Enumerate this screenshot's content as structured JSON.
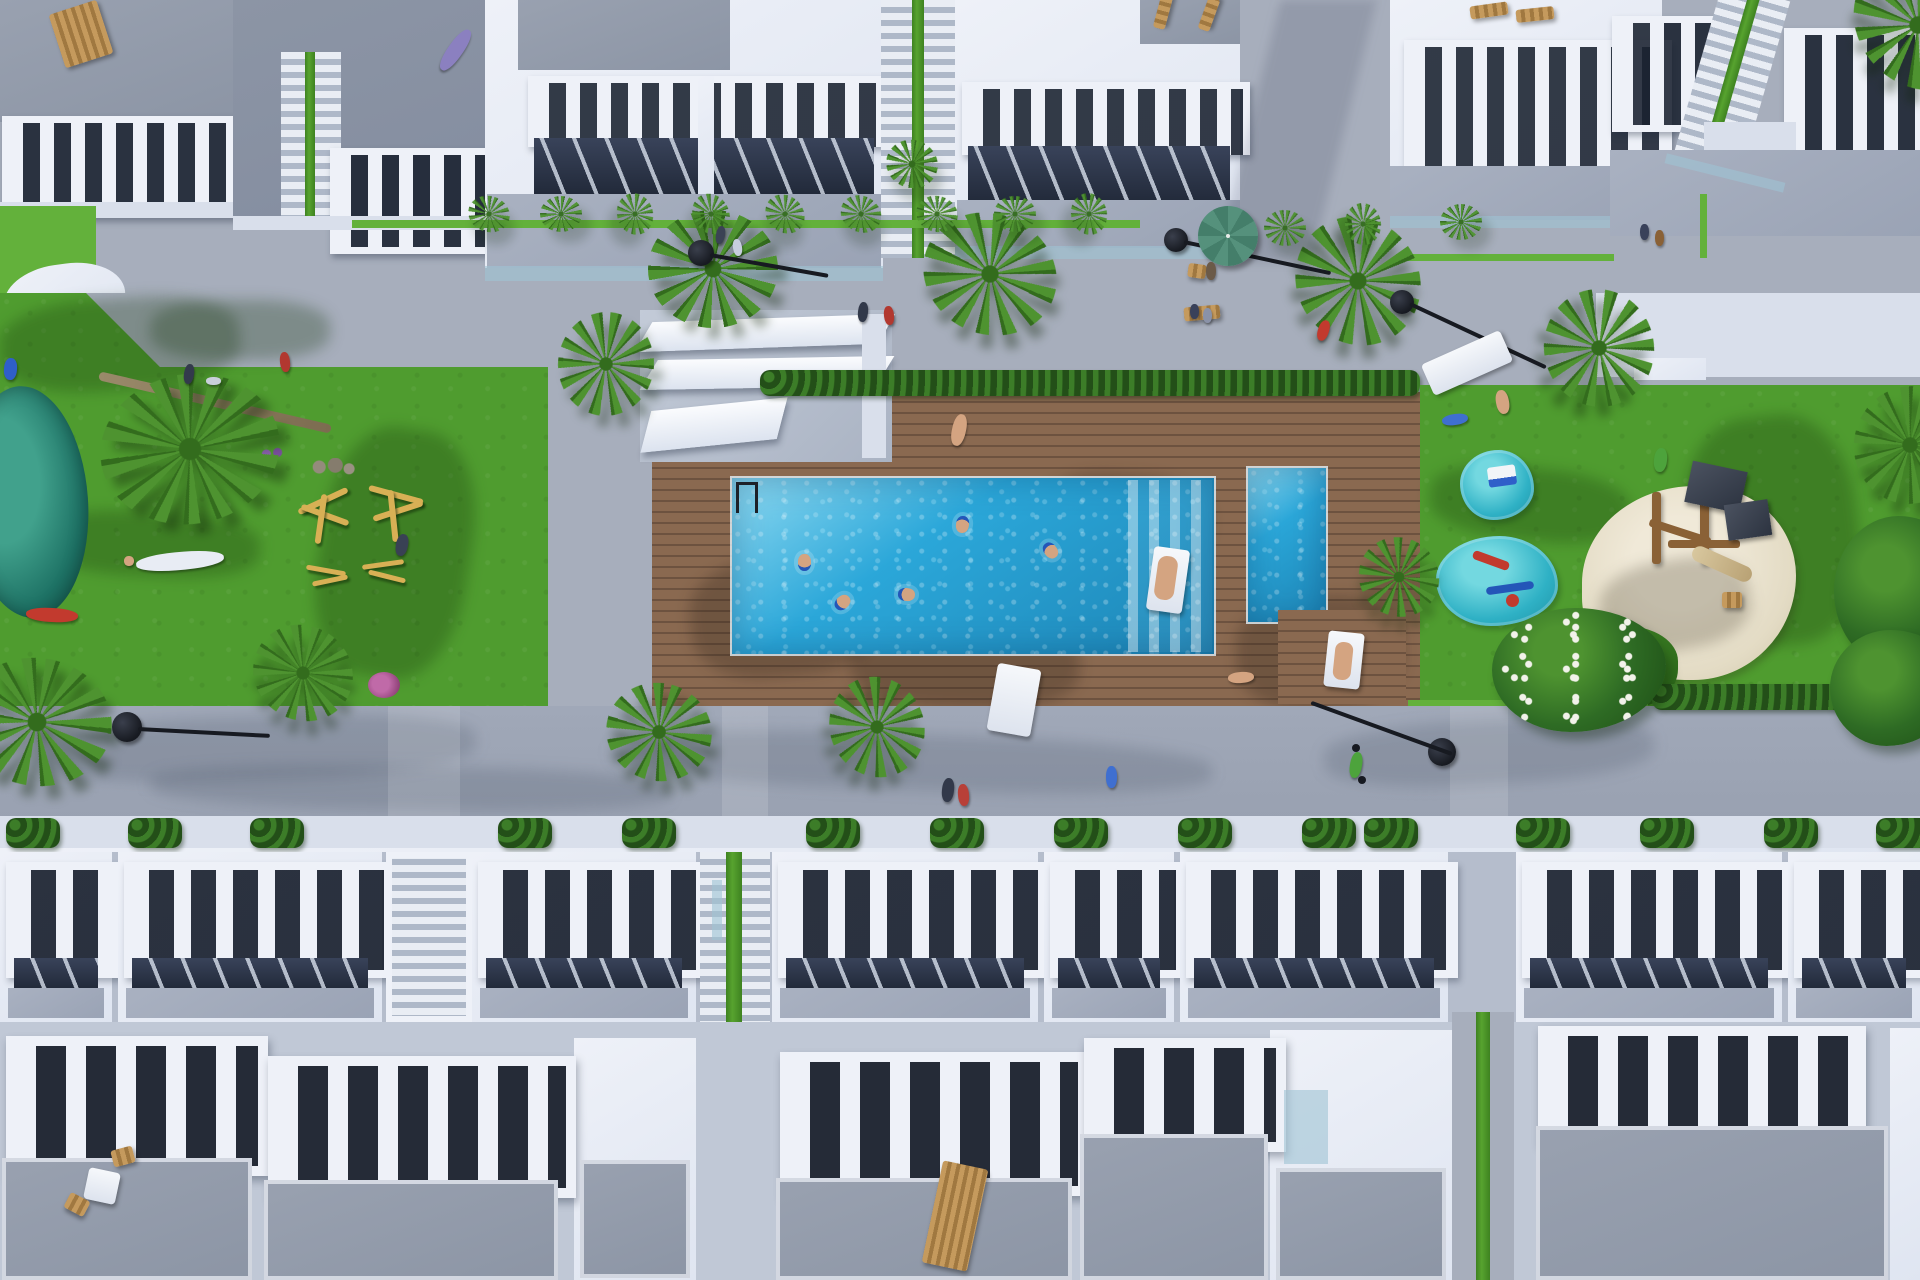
{
  "scene": {
    "kind": "3d-aerial-architectural-render",
    "setting": "residential complex courtyard, top-down view",
    "features": [
      "rows of white townhouses with roof terraces and white balustrades",
      "communal rectangular swimming pool with underwater steps and ladder",
      "separate children's pool",
      "wooden sun deck with plank texture",
      "white pergola shade structure",
      "large lawns with outdoor wooden exercise equipment",
      "small pond",
      "two turquoise children's splash pads with play toys",
      "sand playground with wooden play tower and slide",
      "green mound with red slide",
      "palm trees and dense green hedges",
      "black street lamps with round heads",
      "green parasol on a terrace",
      "sun loungers, wooden deck chairs, bench and outdoor table set",
      "people swimming, sunbathing, walking, cycling and playing"
    ]
  },
  "colors": {
    "concrete": "#a7aebc",
    "street": "#9aa2b2",
    "roof": "#99a1b0",
    "roof2": "#8c95a5",
    "white": "#eef1f8",
    "white2": "#d9dfeb",
    "floor": "#a9b1c1",
    "gap": "#27303f",
    "glass": "#9fc3d4",
    "lawn": "#4f9c2f",
    "lawn2": "#63b13b",
    "lawnshadow": "#2e6317",
    "deck": "#8a6950",
    "deckline": "#6d523f",
    "pool": "#2ba7d9",
    "pooldeep": "#1d85b6",
    "poollight": "#8ed9f1",
    "hedge": "#2d6420",
    "palm": "#4e9330",
    "palmdark": "#336c1d",
    "tree": "#2e6b24",
    "treedark": "#1d4d15",
    "pond": "#1d7164",
    "pond2": "#41a18c",
    "sand": "#e3dbc4",
    "splash": "#2fb1c5",
    "wood": "#c49a5c",
    "wood2": "#8a6136",
    "lamp": "#171a21",
    "umbrella": "#55917c",
    "red": "#c23a2e",
    "blue": "#2f5fc9",
    "skin": "#d4a481"
  }
}
